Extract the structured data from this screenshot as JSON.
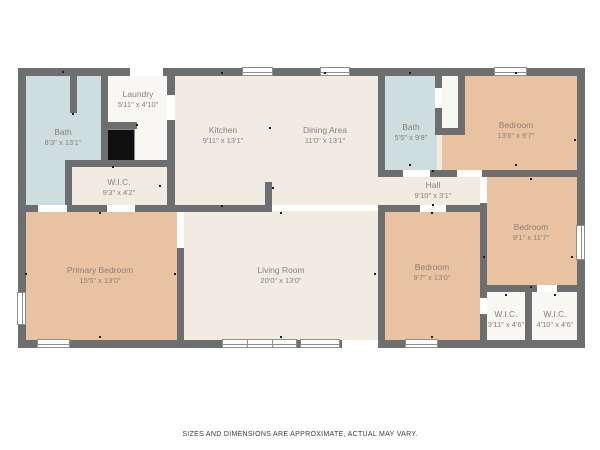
{
  "disclaimer": "SIZES AND DIMENSIONS ARE APPROXIMATE, ACTUAL MAY VARY.",
  "palette": {
    "wall": "#6d6e70",
    "floor_base": "#f2ebe2",
    "floor_bed": "#e9c2a1",
    "floor_wet": "#cedddd",
    "floor_closet": "#f9f7f3",
    "chimney": "#101010",
    "door": "#ffffff",
    "window_border": "#8c8e90",
    "label": "#8b8177",
    "tick": "#1c1c1c"
  },
  "base_rect": [
    22,
    72,
    559,
    272
  ],
  "chimney_rect": [
    107,
    129,
    28,
    33
  ],
  "rooms": [
    {
      "id": "bath-top-left",
      "name": "Bath",
      "dims": "8'3\" x 13'1\"",
      "floor": "wet",
      "rect": [
        26,
        76,
        75,
        129
      ],
      "label": [
        63,
        136
      ]
    },
    {
      "id": "laundry",
      "name": "Laundry",
      "dims": "5'11\" x 4'10\"",
      "floor": "closet",
      "rect": [
        101,
        76,
        66,
        91
      ],
      "label": [
        138,
        98
      ]
    },
    {
      "id": "wic-hallway",
      "name": "W.I.C.",
      "dims": "9'3\" x 4'2\"",
      "floor": "base",
      "rect": [
        70,
        160,
        97,
        45
      ],
      "label": [
        119,
        186
      ]
    },
    {
      "id": "kitchen",
      "name": "Kitchen",
      "dims": "9'11\" x 13'1\"",
      "floor": "none",
      "rect": null,
      "label": [
        223,
        134
      ]
    },
    {
      "id": "dining-area",
      "name": "Dining Area",
      "dims": "11'0\" x 13'1\"",
      "floor": "none",
      "rect": null,
      "label": [
        325,
        134
      ]
    },
    {
      "id": "bath-center",
      "name": "Bath",
      "dims": "5'5\" x 9'8\"",
      "floor": "wet",
      "rect": [
        385,
        76,
        52,
        94
      ],
      "label": [
        411,
        131
      ]
    },
    {
      "id": "bedroom-top-right",
      "name": "Bedroom",
      "dims": "13'6\" x 9'7\"",
      "floor": "bed",
      "rect": [
        442,
        76,
        135,
        94
      ],
      "label": [
        516,
        129
      ]
    },
    {
      "id": "closet-top-right",
      "name": "",
      "dims": "",
      "floor": "closet",
      "rect": [
        442,
        76,
        16,
        59
      ],
      "label": null
    },
    {
      "id": "hall",
      "name": "Hall",
      "dims": "9'10\" x 3'1\"",
      "floor": "none",
      "rect": null,
      "label": [
        433,
        189
      ]
    },
    {
      "id": "bedroom-mid-right",
      "name": "Bedroom",
      "dims": "9'1\" x 11'7\"",
      "floor": "bed",
      "rect": [
        487,
        177,
        90,
        115
      ],
      "label": [
        531,
        231
      ]
    },
    {
      "id": "primary-bedroom",
      "name": "Primary Bedroom",
      "dims": "15'5\" x 13'0\"",
      "floor": "bed",
      "rect": [
        26,
        212,
        151,
        129
      ],
      "label": [
        100,
        274
      ]
    },
    {
      "id": "living-room",
      "name": "Living Room",
      "dims": "20'0\" x 13'0\"",
      "floor": "none",
      "rect": null,
      "label": [
        281,
        274
      ]
    },
    {
      "id": "bedroom-bottom",
      "name": "Bedroom",
      "dims": "9'7\" x 13'0\"",
      "floor": "bed",
      "rect": [
        385,
        212,
        95,
        129
      ],
      "label": [
        432,
        271
      ]
    },
    {
      "id": "wic-left",
      "name": "W.I.C.",
      "dims": "3'11\" x 4'6\"",
      "floor": "closet",
      "rect": [
        487,
        292,
        38,
        49
      ],
      "label": [
        506,
        318
      ]
    },
    {
      "id": "wic-right",
      "name": "W.I.C.",
      "dims": "4'10\" x 4'6\"",
      "floor": "closet",
      "rect": [
        532,
        292,
        45,
        49
      ],
      "label": [
        555,
        318
      ]
    }
  ],
  "walls": [
    [
      18,
      68,
      567,
      8
    ],
    [
      18,
      340,
      567,
      8
    ],
    [
      18,
      68,
      8,
      280
    ],
    [
      577,
      68,
      8,
      280
    ],
    [
      101,
      76,
      7,
      91
    ],
    [
      70,
      76,
      7,
      37
    ],
    [
      65,
      160,
      7,
      45
    ],
    [
      65,
      160,
      102,
      7
    ],
    [
      101,
      122,
      36,
      7
    ],
    [
      167,
      76,
      8,
      136
    ],
    [
      18,
      205,
      254,
      7
    ],
    [
      265,
      182,
      7,
      30
    ],
    [
      378,
      76,
      7,
      101
    ],
    [
      378,
      205,
      7,
      136
    ],
    [
      378,
      170,
      199,
      7
    ],
    [
      435,
      76,
      7,
      59
    ],
    [
      458,
      76,
      7,
      59
    ],
    [
      435,
      128,
      30,
      7
    ],
    [
      385,
      205,
      98,
      7
    ],
    [
      480,
      203,
      7,
      138
    ],
    [
      480,
      285,
      97,
      7
    ],
    [
      525,
      292,
      7,
      49
    ],
    [
      177,
      248,
      7,
      93
    ]
  ],
  "doors": [
    [
      130,
      68,
      33,
      8
    ],
    [
      167,
      95,
      8,
      25
    ],
    [
      38,
      205,
      29,
      7
    ],
    [
      107,
      205,
      28,
      7
    ],
    [
      403,
      170,
      27,
      7
    ],
    [
      457,
      170,
      25,
      7
    ],
    [
      420,
      205,
      26,
      7
    ],
    [
      480,
      177,
      7,
      26
    ],
    [
      480,
      298,
      7,
      16
    ],
    [
      537,
      285,
      20,
      7
    ],
    [
      435,
      88,
      7,
      20
    ],
    [
      177,
      212,
      7,
      36
    ],
    [
      342,
      340,
      36,
      8
    ],
    [
      272,
      205,
      106,
      6
    ]
  ],
  "windows": [
    [
      242,
      67,
      31,
      9,
      1
    ],
    [
      320,
      67,
      30,
      9,
      1
    ],
    [
      494,
      67,
      33,
      9,
      1
    ],
    [
      37,
      339,
      33,
      9,
      1
    ],
    [
      222,
      339,
      75,
      9,
      3
    ],
    [
      300,
      339,
      40,
      9,
      1
    ],
    [
      405,
      339,
      33,
      9,
      1
    ],
    [
      17,
      292,
      9,
      33,
      1
    ],
    [
      576,
      225,
      9,
      35,
      1
    ]
  ],
  "ticks": [
    [
      63,
      72
    ],
    [
      73,
      114
    ],
    [
      137,
      125
    ],
    [
      113,
      167
    ],
    [
      160,
      186
    ],
    [
      222,
      73
    ],
    [
      222,
      206
    ],
    [
      270,
      128
    ],
    [
      273,
      188
    ],
    [
      325,
      73
    ],
    [
      410,
      73
    ],
    [
      410,
      165
    ],
    [
      433,
      171
    ],
    [
      433,
      205
    ],
    [
      516,
      73
    ],
    [
      516,
      165
    ],
    [
      531,
      179
    ],
    [
      531,
      287
    ],
    [
      575,
      140
    ],
    [
      100,
      213
    ],
    [
      100,
      337
    ],
    [
      26,
      274
    ],
    [
      175,
      274
    ],
    [
      281,
      213
    ],
    [
      281,
      337
    ],
    [
      375,
      274
    ],
    [
      432,
      213
    ],
    [
      432,
      337
    ],
    [
      484,
      257
    ],
    [
      572,
      257
    ],
    [
      506,
      295
    ],
    [
      555,
      295
    ]
  ]
}
